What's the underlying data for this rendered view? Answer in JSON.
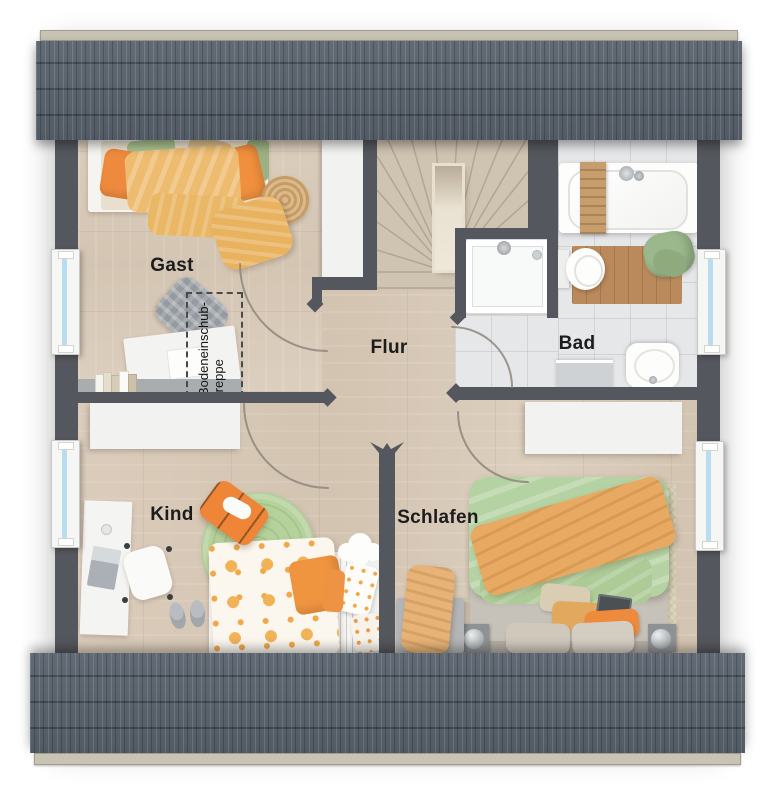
{
  "rooms": {
    "gast": {
      "label": "Gast"
    },
    "flur": {
      "label": "Flur"
    },
    "bad": {
      "label": "Bad"
    },
    "kind": {
      "label": "Kind"
    },
    "schlafen": {
      "label": "Schlafen"
    }
  },
  "annotations": {
    "attic_ladder": {
      "line1": "Bodeneinschub-",
      "line2": "treppe"
    }
  },
  "palette": {
    "roof": "#59626d",
    "wall": "#54575d",
    "wood_floor": "#d8c9b7",
    "tile_floor": "#e6e7e9",
    "window_glass": "#b9ddf0",
    "accent_orange": "#ee8b3d",
    "accent_green": "#abc795",
    "accent_yellow": "#eab966",
    "furniture_white": "#f2f2f0"
  }
}
